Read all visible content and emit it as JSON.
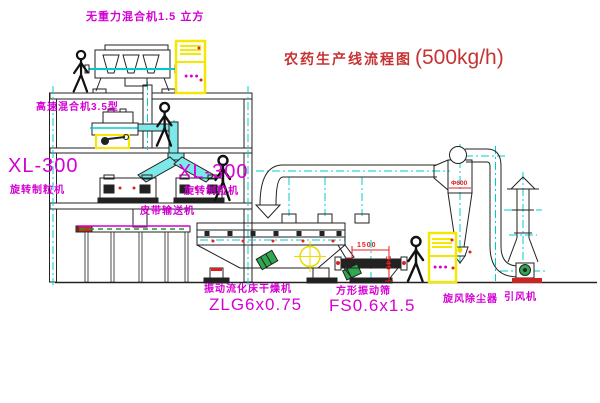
{
  "drawing": {
    "title": {
      "zh": "农药生产线流程图",
      "capacity": "(500kg/h)"
    },
    "equipment_labels": {
      "zero_gravity_mixer": "无重力混合机1.5 立方",
      "high_speed_mixer": "高速混合机3.5型",
      "granulator_left": {
        "model": "XL-300",
        "name": "旋转制粒机"
      },
      "granulator_center": {
        "model": "XL-300",
        "name": "旋转制粒机"
      },
      "belt_conveyor": "皮带输送机",
      "fluid_bed_dryer": {
        "name": "振动流化床干燥机",
        "model": "ZLG6x0.75"
      },
      "vibrating_screen": {
        "name": "方形振动筛",
        "model": "FS0.6x1.5"
      },
      "cyclone": "旋风除尘器",
      "induced_draft_fan": "引风机"
    },
    "dimensions": {
      "screen_length": "1500",
      "screen_height": "540",
      "cyclone_diameter": "Φ600"
    },
    "cabinet_marks": "●●●",
    "colors": {
      "label_magenta": "#d400d4",
      "title_red": "#c63333",
      "centerline_cyan": "#00cccc",
      "highlight_yellow": "#f4e800",
      "dimension_red": "#e02020",
      "motor_green": "#2fa84f"
    }
  }
}
